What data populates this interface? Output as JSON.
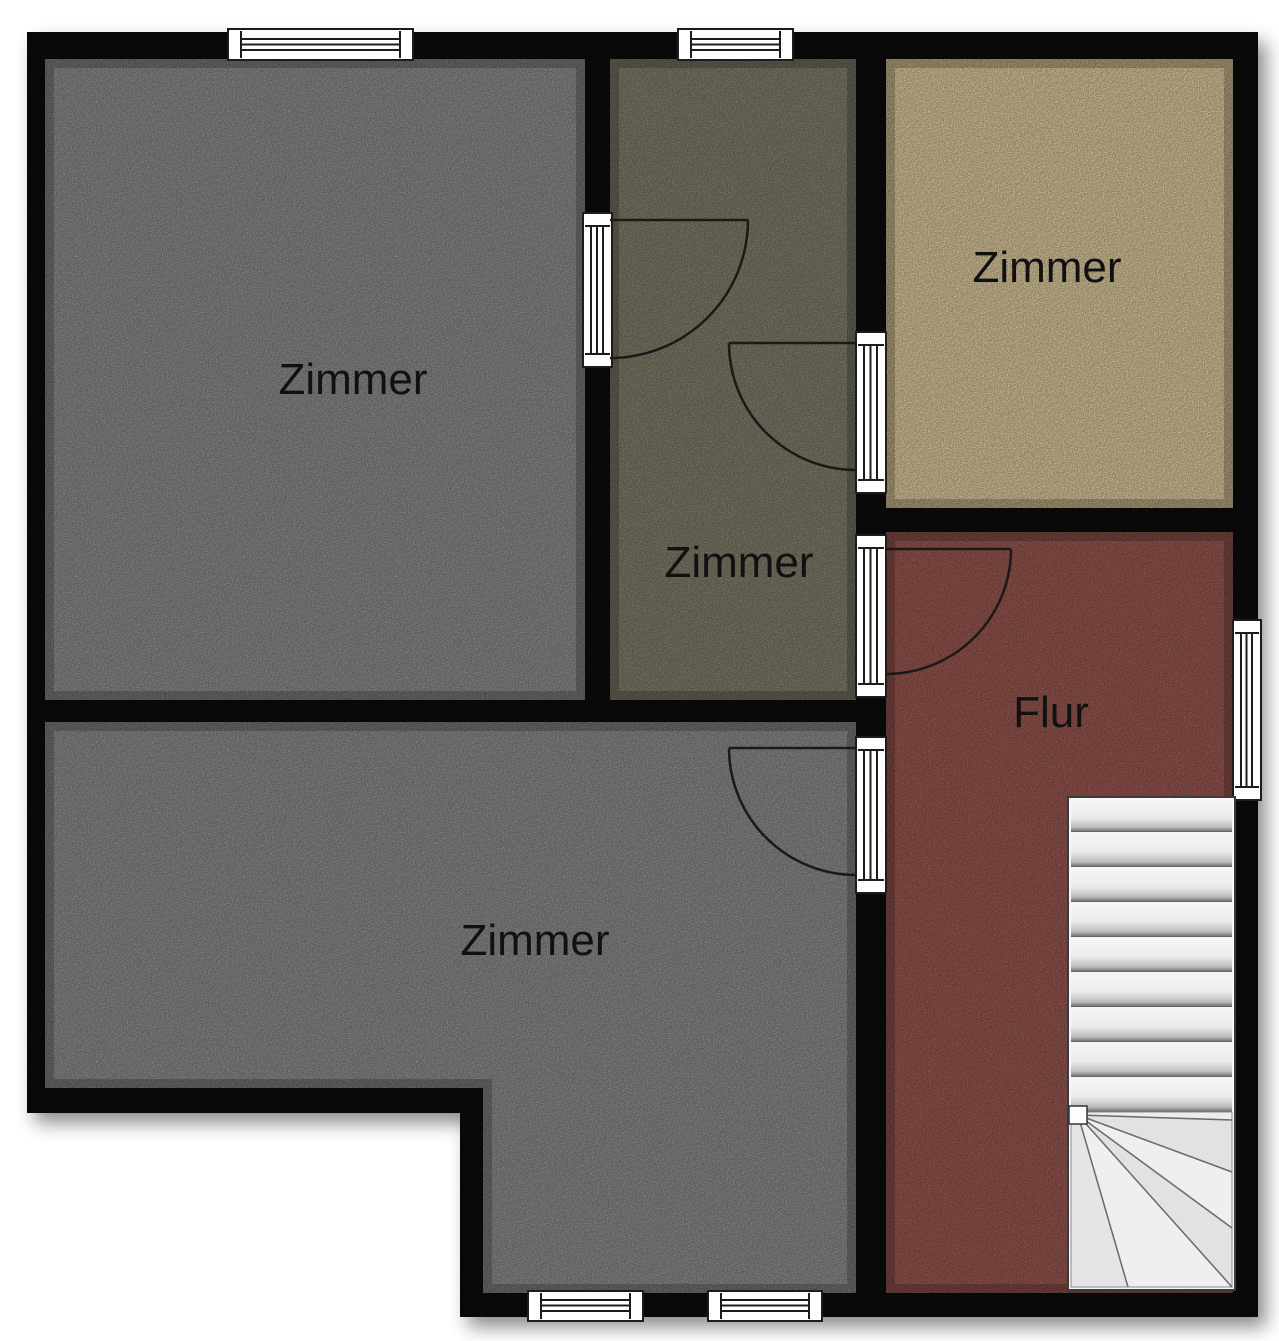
{
  "plan": {
    "type": "floorplan",
    "background": "#ffffff",
    "wall_color": "#0c0c0c",
    "rooms": [
      {
        "name": "zimmer-top-left",
        "label": "Zimmer",
        "color": "#9a9a9d"
      },
      {
        "name": "zimmer-middle",
        "label": "Zimmer",
        "color": "#8e8a75"
      },
      {
        "name": "zimmer-top-right",
        "label": "Zimmer",
        "color": "#f0dcab"
      },
      {
        "name": "flur",
        "label": "Flur",
        "color": "#a86058"
      },
      {
        "name": "zimmer-bottom",
        "label": "Zimmer",
        "color": "#9a9a9d"
      }
    ],
    "stairs": {
      "color": "#f7f7f7",
      "straight_treads": 9,
      "winder_treads": 6
    },
    "window_color": "#ffffff",
    "door_count": 4,
    "window_count": 5
  }
}
